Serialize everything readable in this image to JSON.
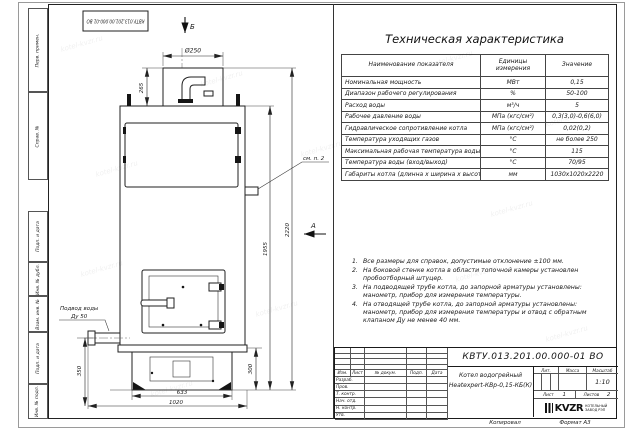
{
  "watermark": {
    "text": "kotel-kvzr.ru"
  },
  "sheet": {
    "copied_label": "Копировал",
    "format_label": "Формат А3"
  },
  "side_strip": [
    "Перв. примен.",
    "Справ. №",
    "Подп. и дата",
    "Инв. № дубл.",
    "Взам. инв. №",
    "Подп. и дата",
    "Инв. № подл."
  ],
  "drawing": {
    "doc_number_top": "КВТУ.013.201.00.000-01 ВО",
    "view_b_label": "Б",
    "view_a_label": "А",
    "dim_diameter": "Ø250",
    "dim_chimney_height": "265",
    "dim_total_height": "2220",
    "dim_body_height": "1955",
    "dim_inlet_height": "350",
    "dim_base_height": "300",
    "dim_base_width": "633",
    "dim_overall_depth": "1020",
    "callout_see_note": "см. п. 2",
    "water_inlet_label_line1": "Подвод воды",
    "water_inlet_label_line2": "Ду 50"
  },
  "table": {
    "title": "Техническая характеристика",
    "headers": [
      "Наименование показателя",
      "Единицы измерения",
      "Значение"
    ],
    "rows": [
      {
        "name": "Номинальная мощность",
        "unit": "МВт",
        "value": "0,15"
      },
      {
        "name": "Диапазон рабочего регулирования",
        "unit": "%",
        "value": "50-100"
      },
      {
        "name": "Расход воды",
        "unit": "м³/ч",
        "value": "5"
      },
      {
        "name": "Рабочее давление воды",
        "unit": "МПа (кгс/см²)",
        "value": "0,3(3,0)-0,6(6,0)"
      },
      {
        "name": "Гидравлическое сопротивление котла",
        "unit": "МПа (кгс/см²)",
        "value": "0,02(0,2)"
      },
      {
        "name": "Температура уходящих газов",
        "unit": "°С",
        "value": "не более 250"
      },
      {
        "name": "Максимальная рабочая температура воды",
        "unit": "°С",
        "value": "115"
      },
      {
        "name": "Температура воды (вход/выход)",
        "unit": "°С",
        "value": "70/95"
      },
      {
        "name": "Габариты котла (длинна х ширина х высота)",
        "unit": "мм",
        "value": "1030х1020х2220"
      }
    ]
  },
  "notes": [
    {
      "num": "1.",
      "text": "Все размеры для справок, допустимые отклонение ±100 мм."
    },
    {
      "num": "2.",
      "text": "На боковой стенке котла в области топочной камеры установлен пробоотборный штуцер."
    },
    {
      "num": "3.",
      "text": "На подводящей трубе котла, до запорной арматуры установлены: манометр, прибор для измерения температуры."
    },
    {
      "num": "4.",
      "text": "На отводящей трубе котла, до запорной арматуры установлены: манометр, прибор для измерения температуры и отвод с обратным клапаном Ду не менее 40 мм."
    }
  ],
  "title_block": {
    "doc_number": "КВТУ.013.201.00.000-01 ВО",
    "product_name_line1": "Котел водогрейный",
    "product_name_line2": "Heatexpert-КВр-0,15-КБ(К)",
    "cols": [
      "Изм.",
      "Лист",
      "№ докум.",
      "Подп.",
      "Дата"
    ],
    "rows": [
      "Разраб.",
      "Пров.",
      "Т. контр.",
      "Нач. отд.",
      "Н. контр.",
      "Утв."
    ],
    "lit_label": "Лит.",
    "mass_label": "Масса",
    "scale_label": "Масштаб",
    "scale_value": "1:10",
    "sheet_label": "Лист",
    "sheet_value": "1",
    "sheets_label": "Листов",
    "sheets_value": "2",
    "logo_text": "KVZR",
    "logo_sub_line1": "КОТЕЛЬНЫЙ",
    "logo_sub_line2": "ЗАВОД РЭП"
  }
}
